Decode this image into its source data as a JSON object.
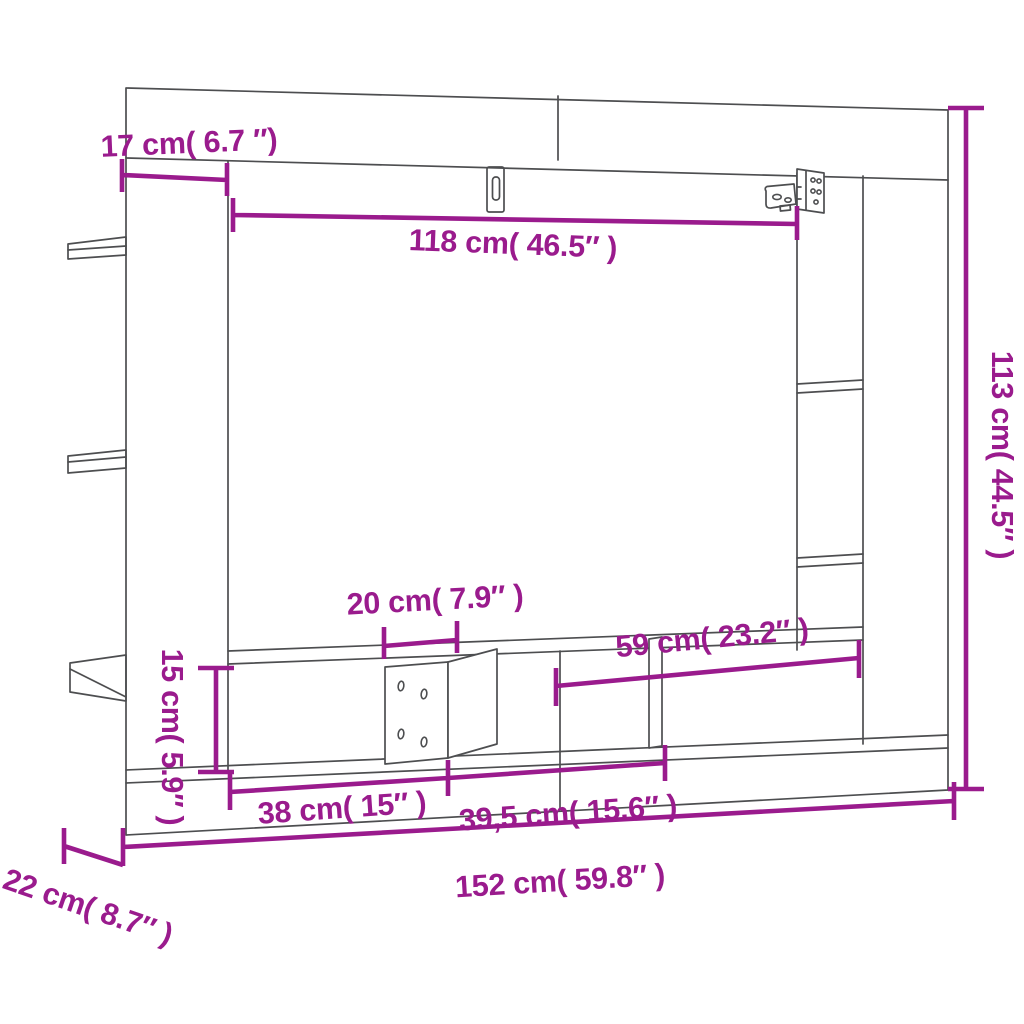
{
  "diagram": {
    "type": "furniture-dimension-diagram",
    "subject": "wall-mounted TV cabinet line drawing with measurements",
    "background_color": "#ffffff",
    "outline_color": "#4d4e50",
    "accent_color": "#9a1b8d",
    "dimensions": [
      {
        "id": "side-frame-width",
        "cm": 17,
        "inches": 6.7,
        "label": "17 cm( 6.7 ″)"
      },
      {
        "id": "inner-opening-width",
        "cm": 118,
        "inches": 46.5,
        "label": "118 cm( 46.5″ )"
      },
      {
        "id": "overall-height",
        "cm": 113,
        "inches": 44.5,
        "label": "113 cm( 44.5″ )"
      },
      {
        "id": "divider-panel-width",
        "cm": 20,
        "inches": 7.9,
        "label": "20 cm( 7.9″ )"
      },
      {
        "id": "right-compartment-width",
        "cm": 59,
        "inches": 23.2,
        "label": "59 cm( 23.2″ )"
      },
      {
        "id": "compartment-height",
        "cm": 15,
        "inches": 5.9,
        "label": "15 cm( 5.9″ )"
      },
      {
        "id": "left-compartment-width",
        "cm": 38,
        "inches": 15,
        "label": "38 cm( 15″ )"
      },
      {
        "id": "middle-compartment-width",
        "cm": 39.5,
        "inches": 15.6,
        "label": "39,5 cm( 15.6″ )"
      },
      {
        "id": "overall-width",
        "cm": 152,
        "inches": 59.8,
        "label": "152 cm( 59.8″ )"
      },
      {
        "id": "overall-depth",
        "cm": 22,
        "inches": 8.7,
        "label": "22 cm( 8.7″ )"
      }
    ]
  }
}
